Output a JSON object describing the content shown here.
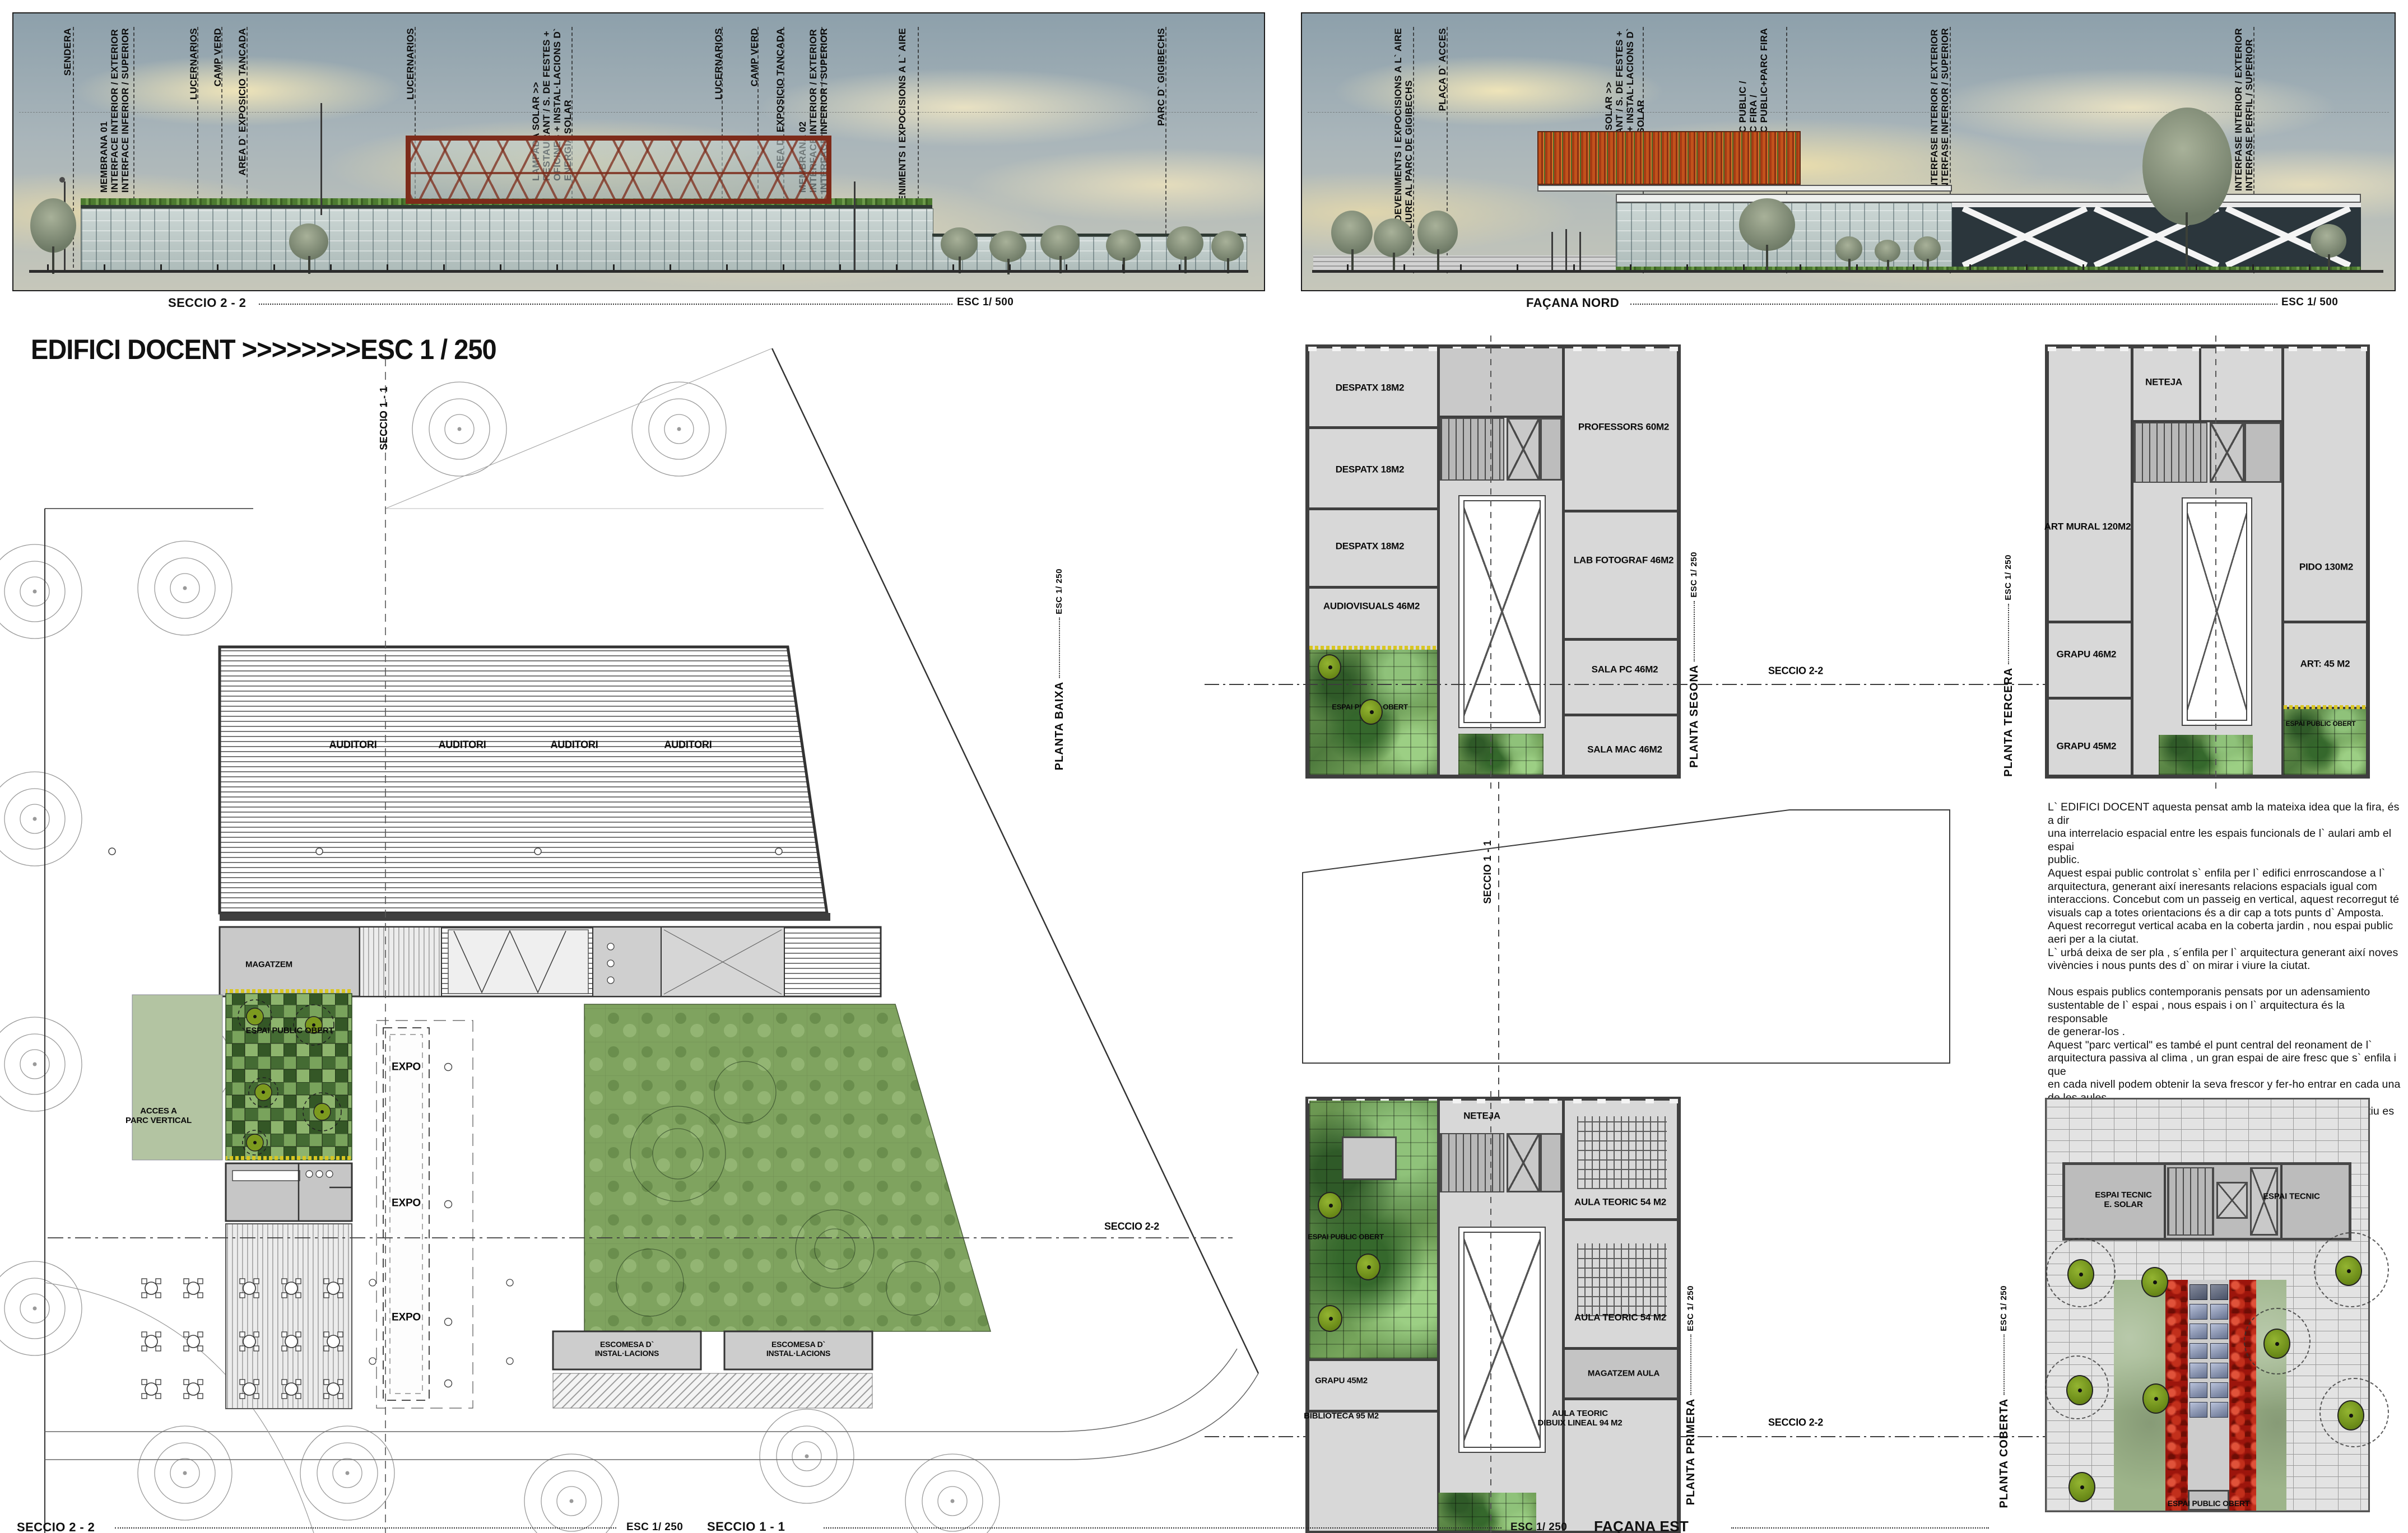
{
  "colors": {
    "sky_top": "#8da0ab",
    "cloud": "#efe3bb",
    "wall": "#3f3f3f",
    "plate": "#d8d8d8",
    "foliage_green": "#5d8648",
    "olive_tree": "#7c9a1e",
    "flower_yellow": "#d8c622",
    "rose_red": "#9c150c",
    "solar_panel_blue": "#65718f",
    "pavilion_red": "#7d2b1a",
    "solar_stripe_orange": "#c2521c"
  },
  "title": {
    "text": "EDIFICI DOCENT >>>>>>>>ESC 1 / 250"
  },
  "sections": {
    "left": {
      "caption": "SECCIO 2 - 2",
      "scale": "ESC 1/ 500"
    },
    "right": {
      "caption": "FAÇANA NORD",
      "scale": "ESC 1/ 500"
    }
  },
  "annotations": {
    "left": [
      {
        "text": "SENDERA"
      },
      {
        "text": "MEMBRANA 01\nINTERFACE INTERIOR / EXTERIOR\nINTERFACE INFERIOR  / SUPERIOR"
      },
      {
        "text": "LUCERNARIOS"
      },
      {
        "text": "CAMP VERD"
      },
      {
        "text": "AREA D` EXPOSICIO TANCADA"
      },
      {
        "text": "LUCERNARIOS"
      },
      {
        "text": "LAMPADA SOLAR >>\nRESTAURANT / S. DE FESTES +\nOFICINES + INSTAL·LACIONS D`\nENERGIA SOLAR"
      },
      {
        "text": "LUCERNARIOS"
      },
      {
        "text": "CAMP VERD"
      },
      {
        "text": "AREA D` EXPOSICIO TANCADA"
      },
      {
        "text": "MEMBRANA 02\nINTERFACE INTERIOR / EXTERIOR\nINTERFACE INFERIOR  / SUPERIOR"
      },
      {
        "text": "ESDEVENIMENTS I EXPOCISIONS A L` AIRE\nLLIURE"
      },
      {
        "text": "PARC D` GIGIBECHS"
      }
    ],
    "right": [
      {
        "text": "ESDEVENIMENTS I EXPOCISIONS A L` AIRE\nLLIURE AL PARC DE GIGIBECHS"
      },
      {
        "text": "PLAÇA D` ACCES"
      },
      {
        "text": "LAMPADA SOLAR >>\nRESTAURANT / S. DE FESTES +\nOFICINES + INSTAL·LACIONS D`\nENERGIA SOLAR"
      },
      {
        "text": "PARC PUBLIC /\nPARC FIRA /\nPARC PUBLIC+PARC FIRA"
      },
      {
        "text": "INTERFASE INTERIOR / EXTERIOR\nINTERFASE INFERIOR / SUPERIOR"
      },
      {
        "text": "INTERFASE INTERIOR / EXTERIOR\nINTERFASE PERFIL / SUPERIOR"
      }
    ]
  },
  "plans": {
    "baixa": {
      "name": "PLANTA BAIXA",
      "esc": "ESC 1/ 250",
      "auditori": "AUDITORI",
      "magatzem": "MAGATZEM",
      "expo": "EXPO",
      "acces": "ACCES A\nPARC VERTICAL",
      "espai_public": "ESPAI PUBLIC OBERT",
      "escomesa": "ESCOMESA D`\nINSTAL·LACIONS",
      "seccio11": "SECCIO 1 - 1",
      "seccio22": "SECCIO 2-2"
    },
    "segona": {
      "name": "PLANTA SEGONA",
      "esc": "ESC 1/ 250",
      "rooms": {
        "despatx": "DESPATX 18M2",
        "audiovisuals": "AUDIOVISUALS 46M2",
        "professors": "PROFESSORS 60M2",
        "lab": "LAB FOTOGRAF 46M2",
        "salapc": "SALA PC 46M2",
        "salamac": "SALA MAC 46M2",
        "espai": "ESPAI PUBLIC OBERT"
      }
    },
    "tercera": {
      "name": "PLANTA TERCERA",
      "esc": "ESC 1/ 250",
      "rooms": {
        "neteja": "NETEJA",
        "artmural": "ART MURAL 120M2",
        "pido": "PIDO 130M2",
        "grapu46": "GRAPU 46M2",
        "grapu45": "GRAPU 45M2",
        "art45": "ART: 45 M2",
        "espai": "ESPAI PUBLIC OBERT"
      }
    },
    "primera": {
      "name": "PLANTA PRIMERA",
      "esc": "ESC 1/ 250",
      "rooms": {
        "neteja": "NETEJA",
        "espai": "ESPAI PUBLIC OBERT",
        "aula": "AULA TEORIC 54 M2",
        "magatzem_aula": "MAGATZEM AULA",
        "grapu45": "GRAPU 45M2",
        "biblioteca": "BIBLIOTECA 95 M2",
        "dibuix": "AULA TEORIC\nDIBUIX LINEAL 94 M2"
      }
    },
    "coberta": {
      "name": "PLANTA COBERTA",
      "esc": "ESC 1/ 250",
      "rooms": {
        "tecnic_solar": "ESPAI TECNIC\nE. SOLAR",
        "tecnic": "ESPAI TECNIC",
        "espai": "ESPAI PUBLIC OBERT"
      }
    }
  },
  "markers": {
    "seccio11": "SECCIO 1 - 1",
    "seccio22": "SECCIO 2-2"
  },
  "footer": {
    "seccio22": "SECCIO 2 - 2",
    "esc250": "ESC 1/ 250",
    "seccio11": "SECCIO 1 - 1",
    "facana_est": "FAÇANA EST"
  },
  "description": {
    "text": "L` EDIFICI DOCENT aquesta pensat amb la mateixa idea que la fira, és a dir\nuna interrelacio espacial entre les espais funcionals de l` aulari amb el espai\npublic.\nAquest espai public controlat  s` enfila per l` edifici enrroscandose a l`\narquitectura, generant així ineresants relacions espacials  igual com\ninteraccions. Concebut com un passeig en vertical, aquest recorregut té\nvisuals cap a totes  orientacions és  a dir cap a tots  punts d` Amposta.\nAquest recorregut vertical acaba en la coberta jardin , nou espai public\naeri per a la ciutat.\nL` urbá deixa de ser pla , s´enfila per l` arquitectura generant així noves\nvivències i nous punts des d` on mirar i viure la ciutat.\n\nNous espais publics contemporanis pensats por un adensamiento\nsustentable de l` espai , nous espais i on l` arquitectura és la responsable\nde generar-los .\nAquest  \"parc vertical\" es també el punt central del reonament de l`\narquitectura passiva al clima , un gran espai de aire fresc que s` enfila i que\nen cada nivell podem obtenir la seva frescor y fer-ho entrar en cada una\nde les aules.\nL'atri gran xemeneia d` aire calent , s` obre per expulsar-la  a l` estiu es\ntanca per conservar-lo a l`hivern."
  }
}
